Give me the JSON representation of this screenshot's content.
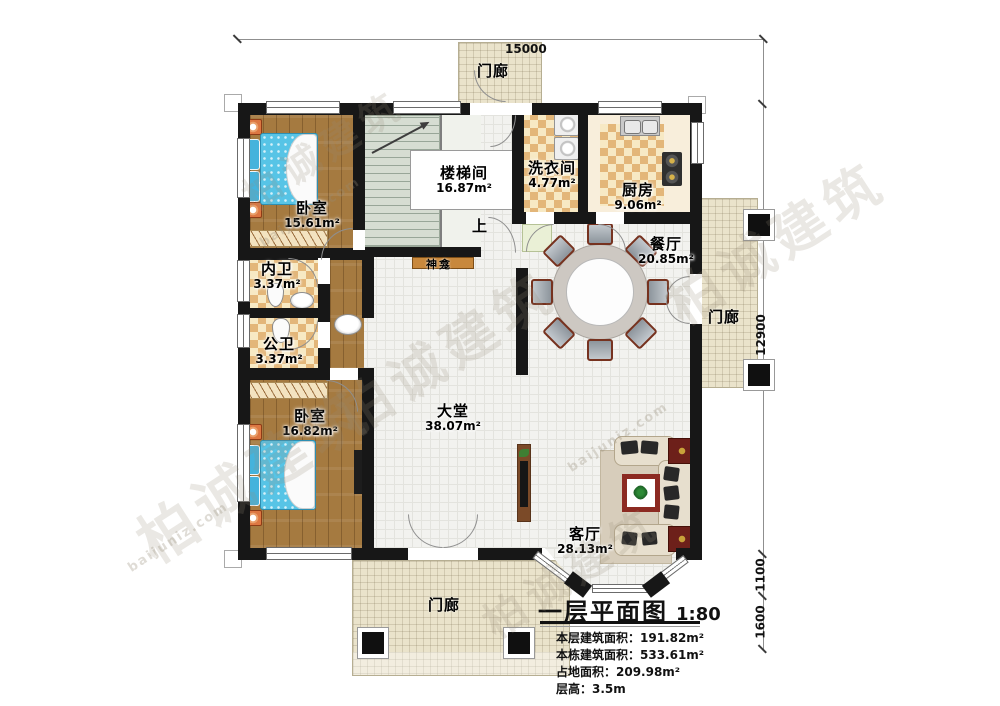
{
  "watermark": {
    "brand": "柏诚建筑",
    "site": "baijuniz.com"
  },
  "dimensions": {
    "top": "15000",
    "right": "12900",
    "right_lower": "1100",
    "right_bottom": "1600"
  },
  "labels": {
    "up": "上",
    "shrine": "神龛"
  },
  "rooms": {
    "porch_top": {
      "name": "门廊"
    },
    "porch_right": {
      "name": "门廊"
    },
    "porch_bottom": {
      "name": "门廊"
    },
    "stairwell": {
      "name": "楼梯间",
      "area": "16.87m²"
    },
    "laundry": {
      "name": "洗衣间",
      "area": "4.77m²"
    },
    "kitchen": {
      "name": "厨房",
      "area": "9.06m²"
    },
    "dining": {
      "name": "餐厅",
      "area": "20.85m²"
    },
    "bedroom1": {
      "name": "卧室",
      "area": "15.61m²"
    },
    "ensuite": {
      "name": "内卫",
      "area": "3.37m²"
    },
    "bath": {
      "name": "公卫",
      "area": "3.37m²"
    },
    "bedroom2": {
      "name": "卧室",
      "area": "16.82m²"
    },
    "hall": {
      "name": "大堂",
      "area": "38.07m²"
    },
    "living": {
      "name": "客厅",
      "area": "28.13m²"
    }
  },
  "title_block": {
    "title": "一层平面图",
    "scale": "1:80",
    "stats": [
      "本层建筑面积：191.82m²",
      "本栋建筑面积：533.61m²",
      "占地面积：209.98m²",
      "层高：3.5m"
    ]
  }
}
